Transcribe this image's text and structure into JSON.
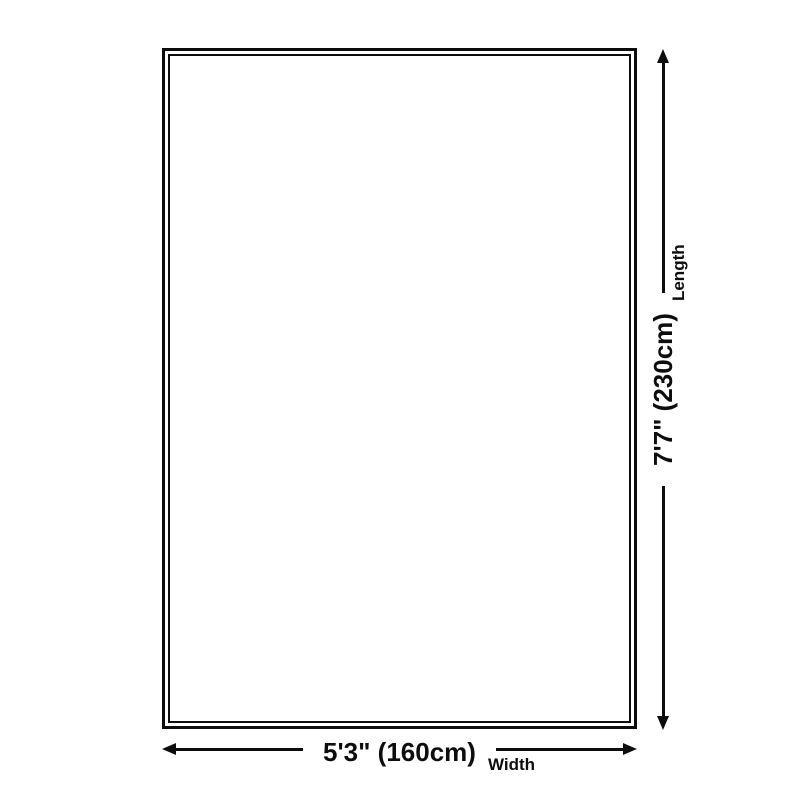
{
  "diagram": {
    "background_color": "#ffffff",
    "line_color": "#0d0d0d",
    "product_outline": "rectangle-double-border",
    "width": {
      "value": "5'3\" (160cm)",
      "label": "Width"
    },
    "length": {
      "value": "7'7\" (230cm)",
      "label": "Length"
    }
  }
}
